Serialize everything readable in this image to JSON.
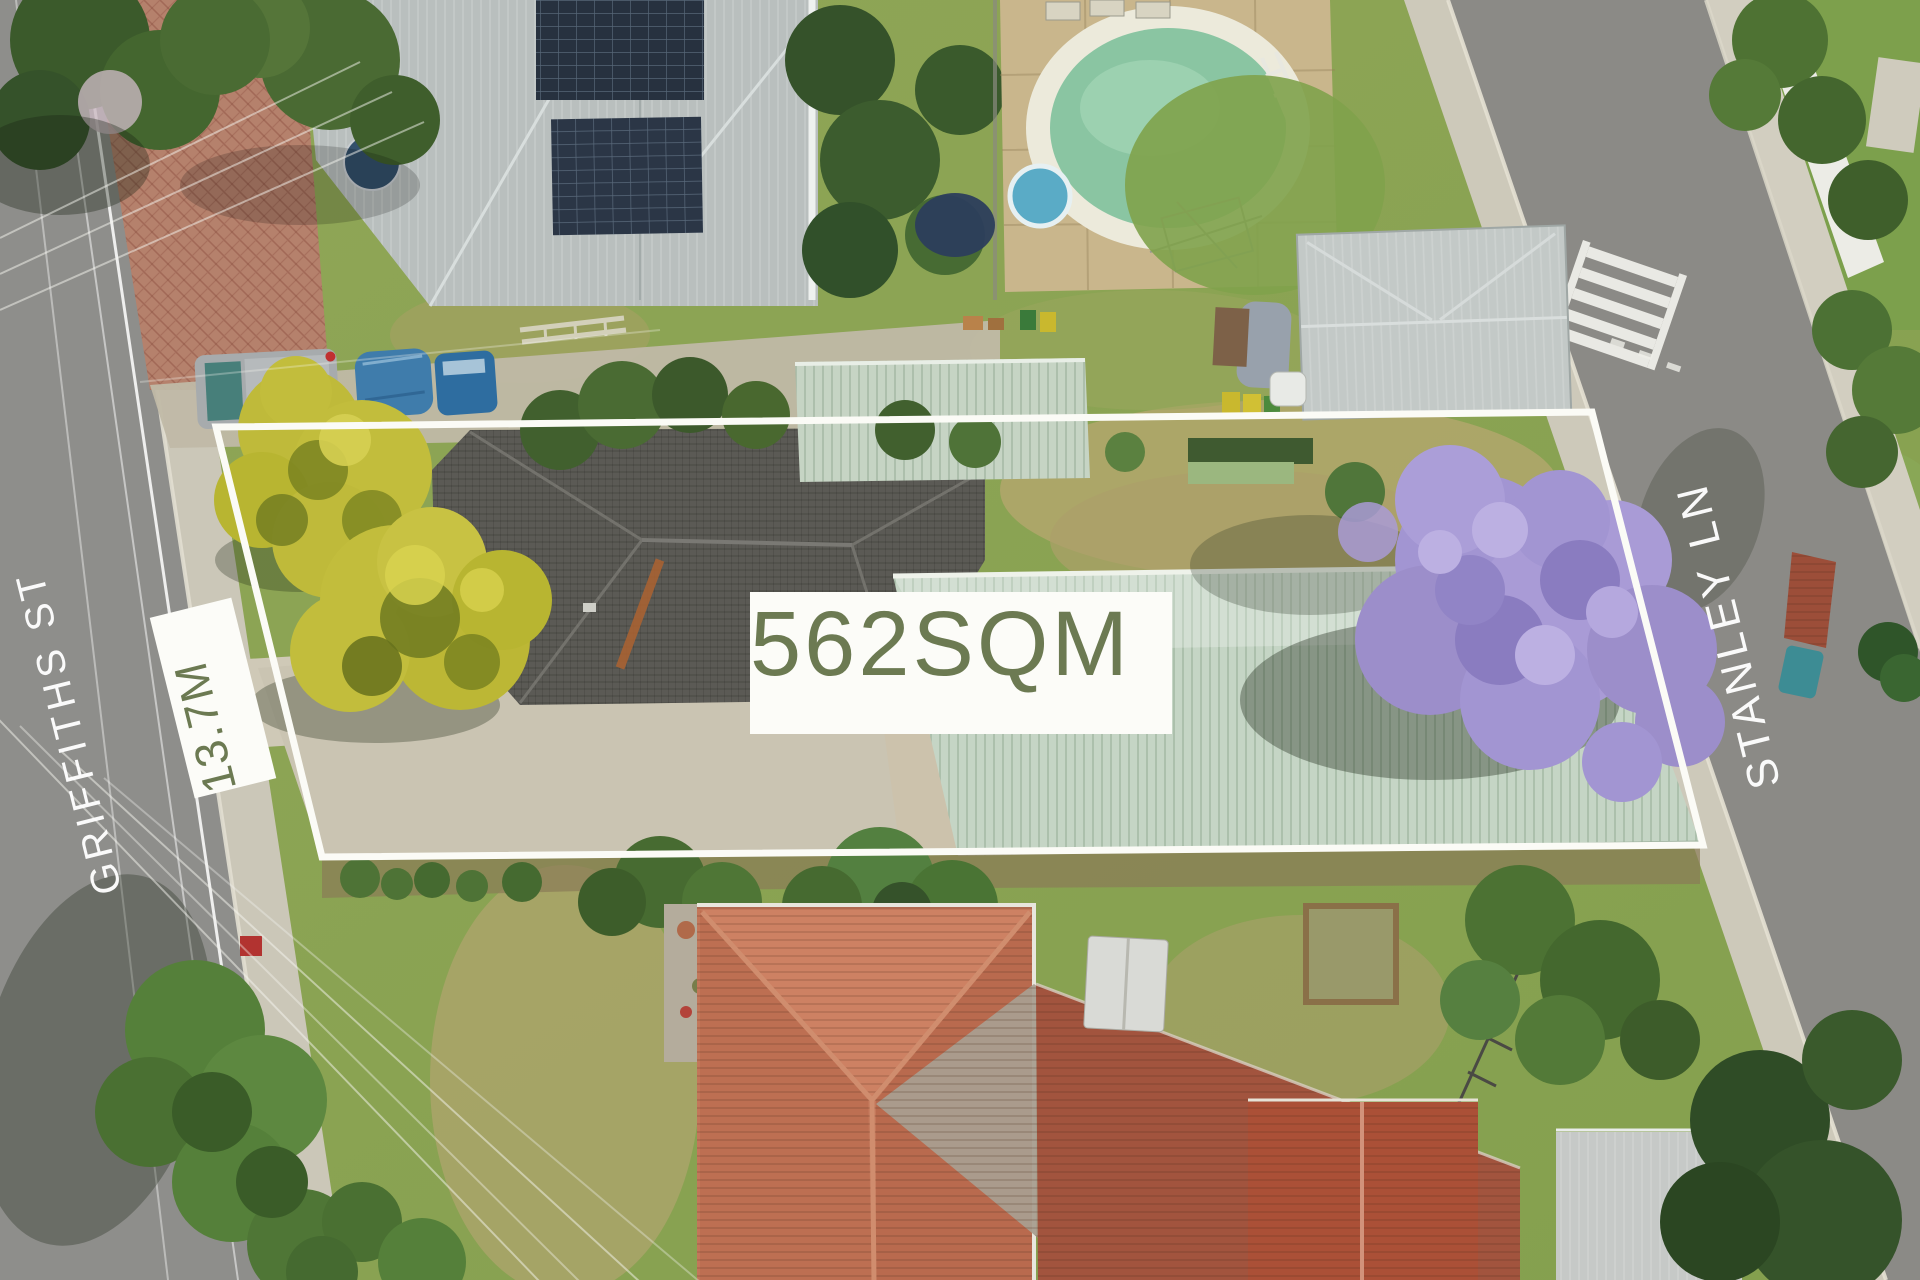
{
  "overlays": {
    "area_label": "562SQM",
    "frontage_label": "13.7M"
  },
  "streets": {
    "left": "GRIFFITHS ST",
    "right": "STANLEY LN"
  },
  "colors": {
    "overlay_text_olive": "#6c7a52",
    "overlay_box_white": "#fcfcf8",
    "boundary_line_white": "#fbfbf6",
    "street_text_white": "#ffffff",
    "pool_water_green": "#8ac5a2",
    "jacaranda_purple": "#a295d2",
    "terracotta_roof": "#c3775a",
    "pale_green_roof": "#c5d5c5"
  }
}
